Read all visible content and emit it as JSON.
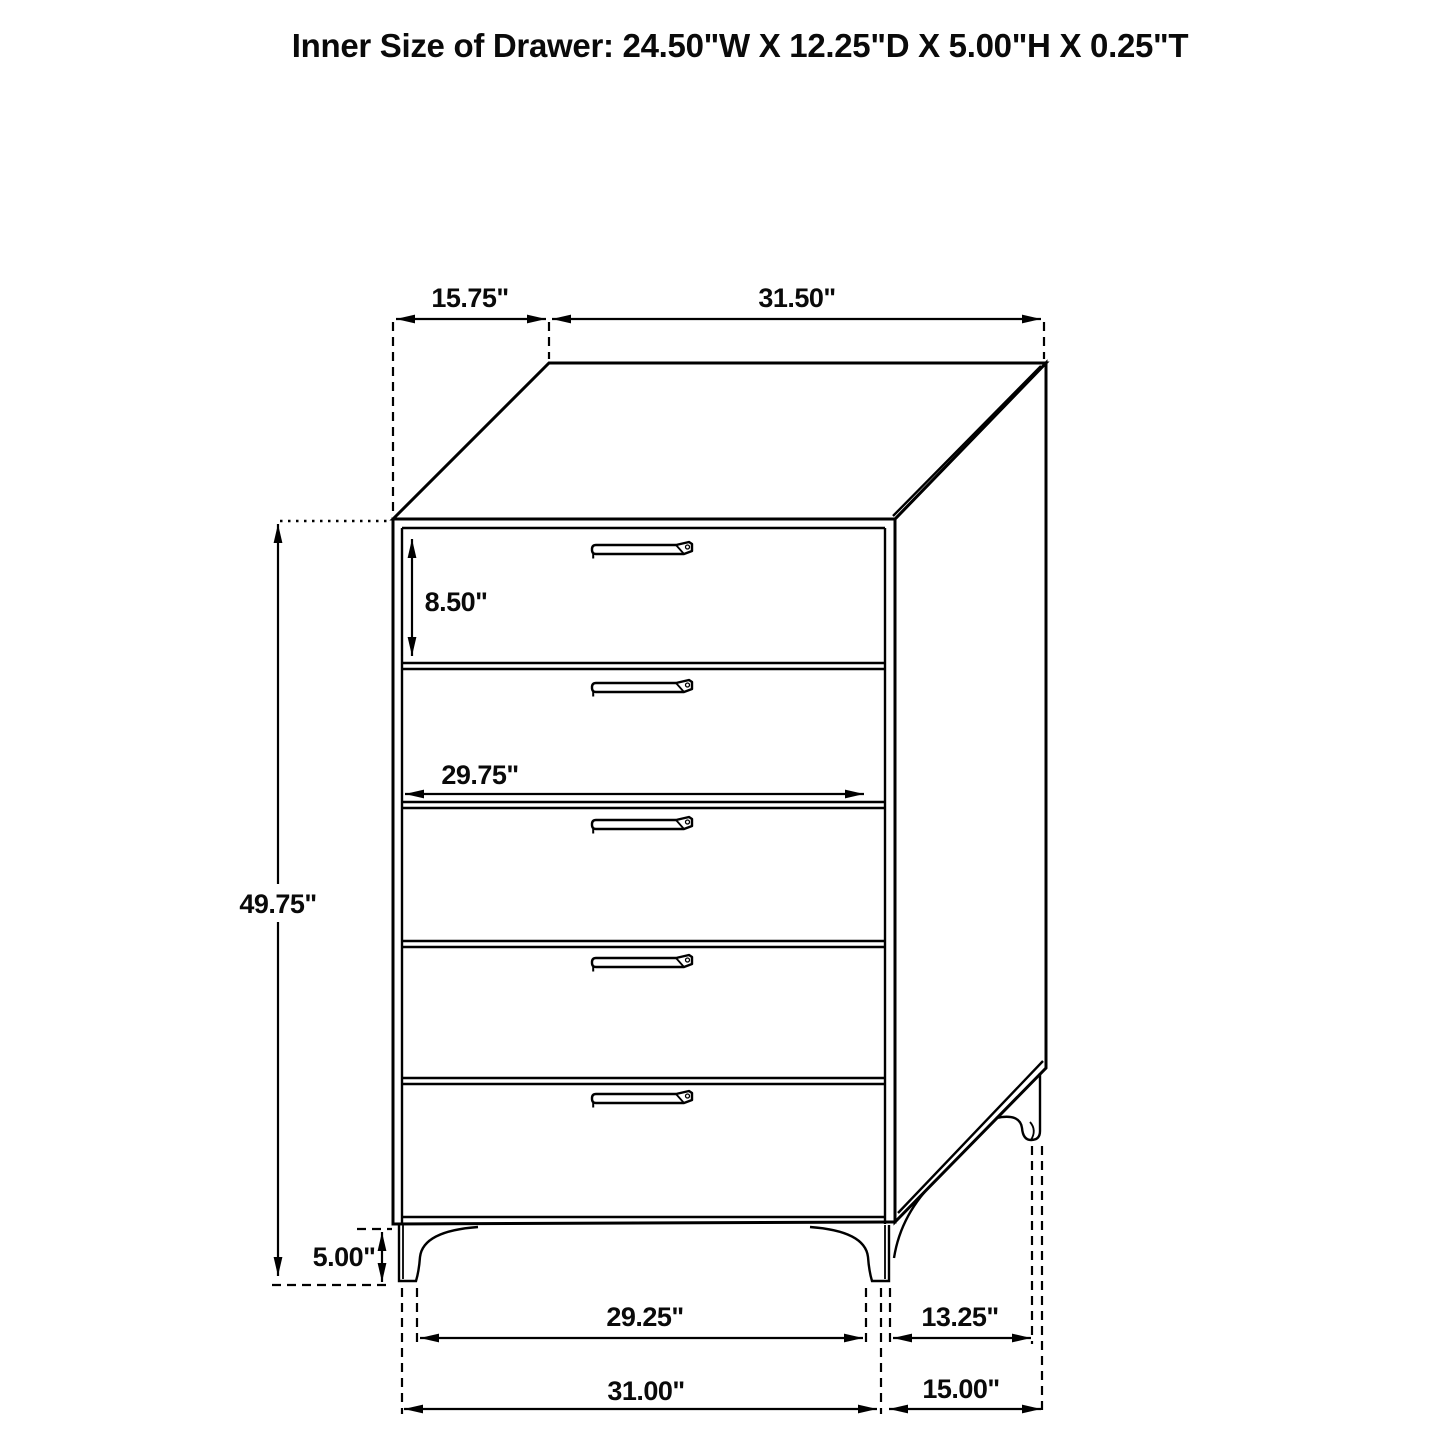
{
  "title": "Inner Size of Drawer: 24.50\"W X 12.25\"D X 5.00\"H X 0.25\"T",
  "drawing": {
    "type": "technical-line-drawing",
    "subject": "5-drawer chest dimension diagram",
    "drawer_count": 5,
    "line_color": "#000000",
    "background_color": "#ffffff"
  },
  "labels": {
    "top_depth": "15.75\"",
    "top_width": "31.50\"",
    "first_drawer_height": "8.50\"",
    "drawer_front_width": "29.75\"",
    "overall_height": "49.75\"",
    "foot_height": "5.00\"",
    "feet_inner_width": "29.25\"",
    "feet_inner_depth": "13.25\"",
    "feet_outer_width": "31.00\"",
    "feet_outer_depth": "15.00\""
  }
}
